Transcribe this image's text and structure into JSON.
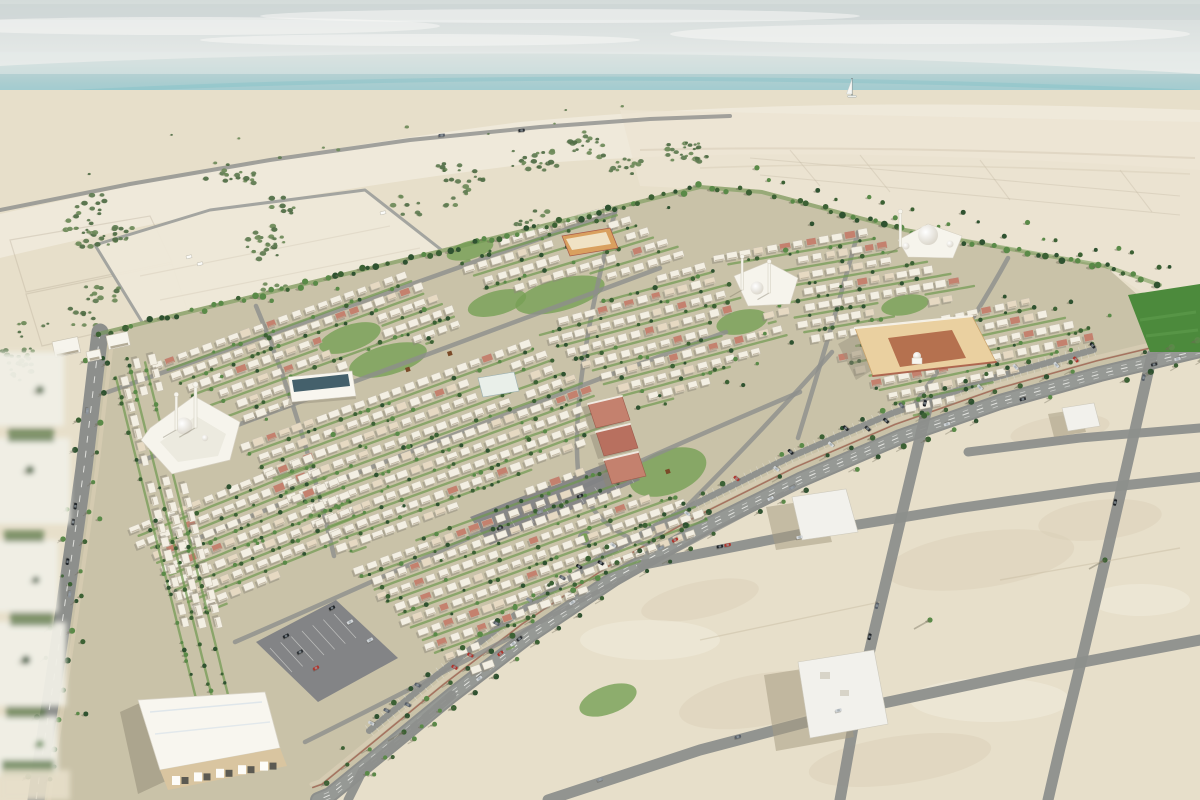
{
  "scene": {
    "type": "architectural-aerial-rendering",
    "title": "Aerial rendering of a coastal desert residential masterplan community beside a turquoise sea",
    "environment": {
      "water": "sea",
      "shore": "beach",
      "terrain": "desert",
      "vegetation": "scrub-and-palms"
    },
    "landmarks": [
      {
        "name": "west-mosque"
      },
      {
        "name": "central-mosque"
      },
      {
        "name": "north-mosque"
      },
      {
        "name": "retail-strip"
      },
      {
        "name": "community-center"
      },
      {
        "name": "school-campus"
      },
      {
        "name": "neighborhood-center"
      },
      {
        "name": "apartment-blocks"
      },
      {
        "name": "sports-field"
      },
      {
        "name": "sailboat"
      },
      {
        "name": "fenced-vacant-plot"
      },
      {
        "name": "vacant-plots-grid"
      },
      {
        "name": "entry-pavilions"
      }
    ],
    "palette": {
      "skyTop": "#d4dbda",
      "skyBot": "#eff1ef",
      "cloud": "#f7f8f6",
      "sea0": "#ccd8d6",
      "sea1": "#a9cdd0",
      "sea2": "#84c6ce",
      "sea3": "#8ccfd4",
      "sea4": "#b2dada",
      "seaStreak": "#6fb9c2",
      "foam": "#f4f6f0",
      "shallow": "#cfdcd2",
      "sand": "#e7dfca",
      "beach": "#efe9da",
      "desertLight": "#ece4d2",
      "sandShade": "#d9cfb6",
      "sandLight": "#f2edde",
      "scrub": "#e2dbc6",
      "shrub1": "#4e6b44",
      "shrub2": "#5d7a50",
      "shrub3": "#6b8a58",
      "plotFill": "#eee8d8",
      "fence": "#9b9d9a",
      "sketch": "#b8ad98",
      "track": "#d5cab4",
      "road": "#8d8f8c",
      "roadLight": "#9a9c99",
      "dash": "#f2f2ef",
      "devBase": "#c9c2a8",
      "green": "#77a055",
      "greenDark": "#4c8a3c",
      "greenStrip": "#6f9850",
      "tree": "#3c6134",
      "treeDark": "#2f5230",
      "treeLight": "#5a8a48",
      "treeShadow": "#6f6a56",
      "house": "#f3efe3",
      "houseTan": "#e6d9c2",
      "houseRed": "#c4816e",
      "houseShadow": "#8e887a",
      "houseEdge": "#c6bfae",
      "wallBrick": "#9c5f4d",
      "sidewalk": "#d8cdb4",
      "mosqueWhite": "#f6f4ec",
      "domeShade": "#cfc9ba",
      "orangeWall": "#ead0a0",
      "orangeDeep": "#d9a05f",
      "court": "#b5714f",
      "redAccent": "#a85a48",
      "schoolWall": "#d9c5a0",
      "roofWhite": "#f8f6ef",
      "roofBlue": "#dae3ea",
      "tealRoof": "#44606b",
      "parking": "#7f8184",
      "carDark": "#2e3236",
      "carLight": "#d6d9db",
      "carMid": "#596069",
      "slabWhite": "#f2f1ec",
      "slabShadow": "#a79d84",
      "blurWhite": "#f0efe6"
    }
  }
}
